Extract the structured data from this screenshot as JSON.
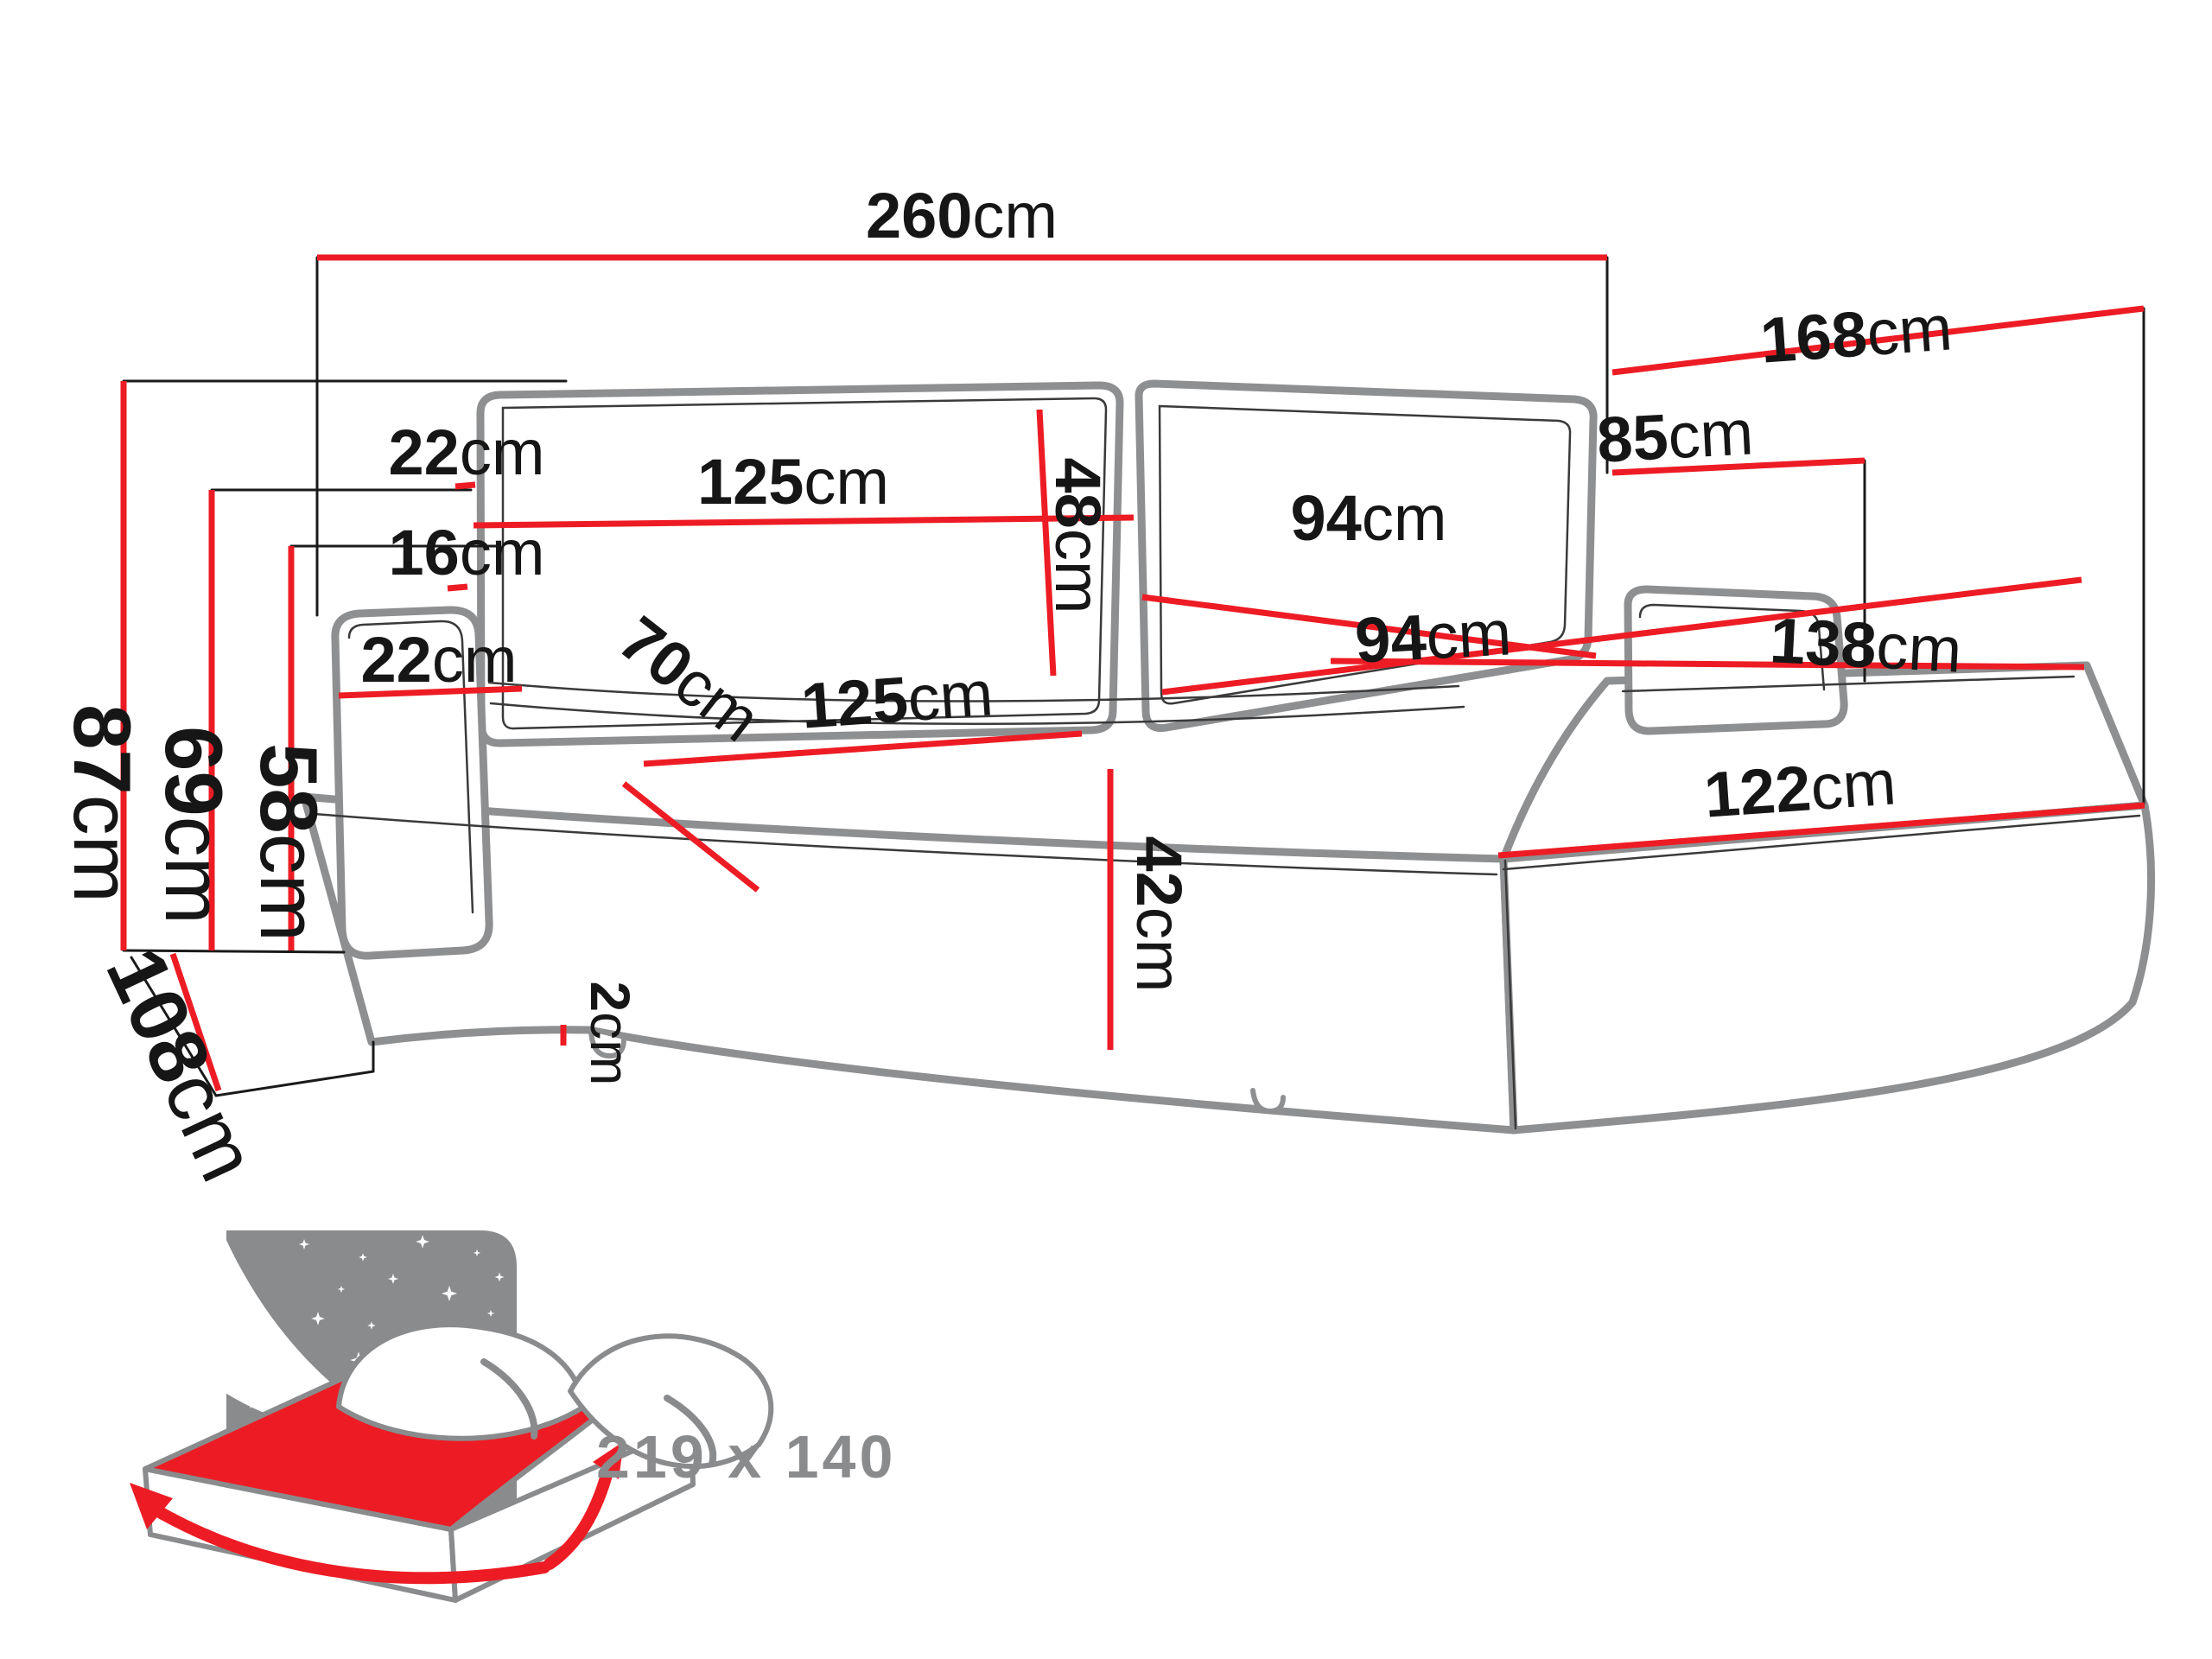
{
  "colors": {
    "accent_red": "#ed1c24",
    "sketch_gray": "#8e8f91",
    "label_black": "#161616",
    "icon_gray": "#8a8b8d",
    "background": "#ffffff"
  },
  "dims": {
    "total_width": {
      "value": "260",
      "unit": "cm"
    },
    "chaise_length": {
      "value": "168",
      "unit": "cm"
    },
    "chaise_back_height": {
      "value": "85",
      "unit": "cm"
    },
    "back_cushion_thickness": {
      "value": "22",
      "unit": "cm"
    },
    "left_back_cushion_width": {
      "value": "125",
      "unit": "cm"
    },
    "back_cushion_height": {
      "value": "48",
      "unit": "cm"
    },
    "right_back_cushion_width": {
      "value": "94",
      "unit": "cm"
    },
    "backrest_to_armrest_gap": {
      "value": "16",
      "unit": "cm"
    },
    "armrest_width": {
      "value": "22",
      "unit": "cm"
    },
    "left_seat_width": {
      "value": "125",
      "unit": "cm"
    },
    "seat_depth": {
      "value": "70",
      "unit": "cm"
    },
    "right_seat_width": {
      "value": "94",
      "unit": "cm"
    },
    "chaise_width": {
      "value": "138",
      "unit": "cm"
    },
    "chaise_front_length": {
      "value": "122",
      "unit": "cm"
    },
    "seat_front_height": {
      "value": "42",
      "unit": "cm"
    },
    "total_height": {
      "value": "87",
      "unit": "cm"
    },
    "armrest_height": {
      "value": "69",
      "unit": "cm"
    },
    "seat_height": {
      "value": "58",
      "unit": "cm"
    },
    "total_depth": {
      "value": "108",
      "unit": "cm"
    },
    "floor_clearance": {
      "value": "2",
      "unit": "cm"
    }
  },
  "sleeping_area": {
    "label": "219 x 140"
  }
}
